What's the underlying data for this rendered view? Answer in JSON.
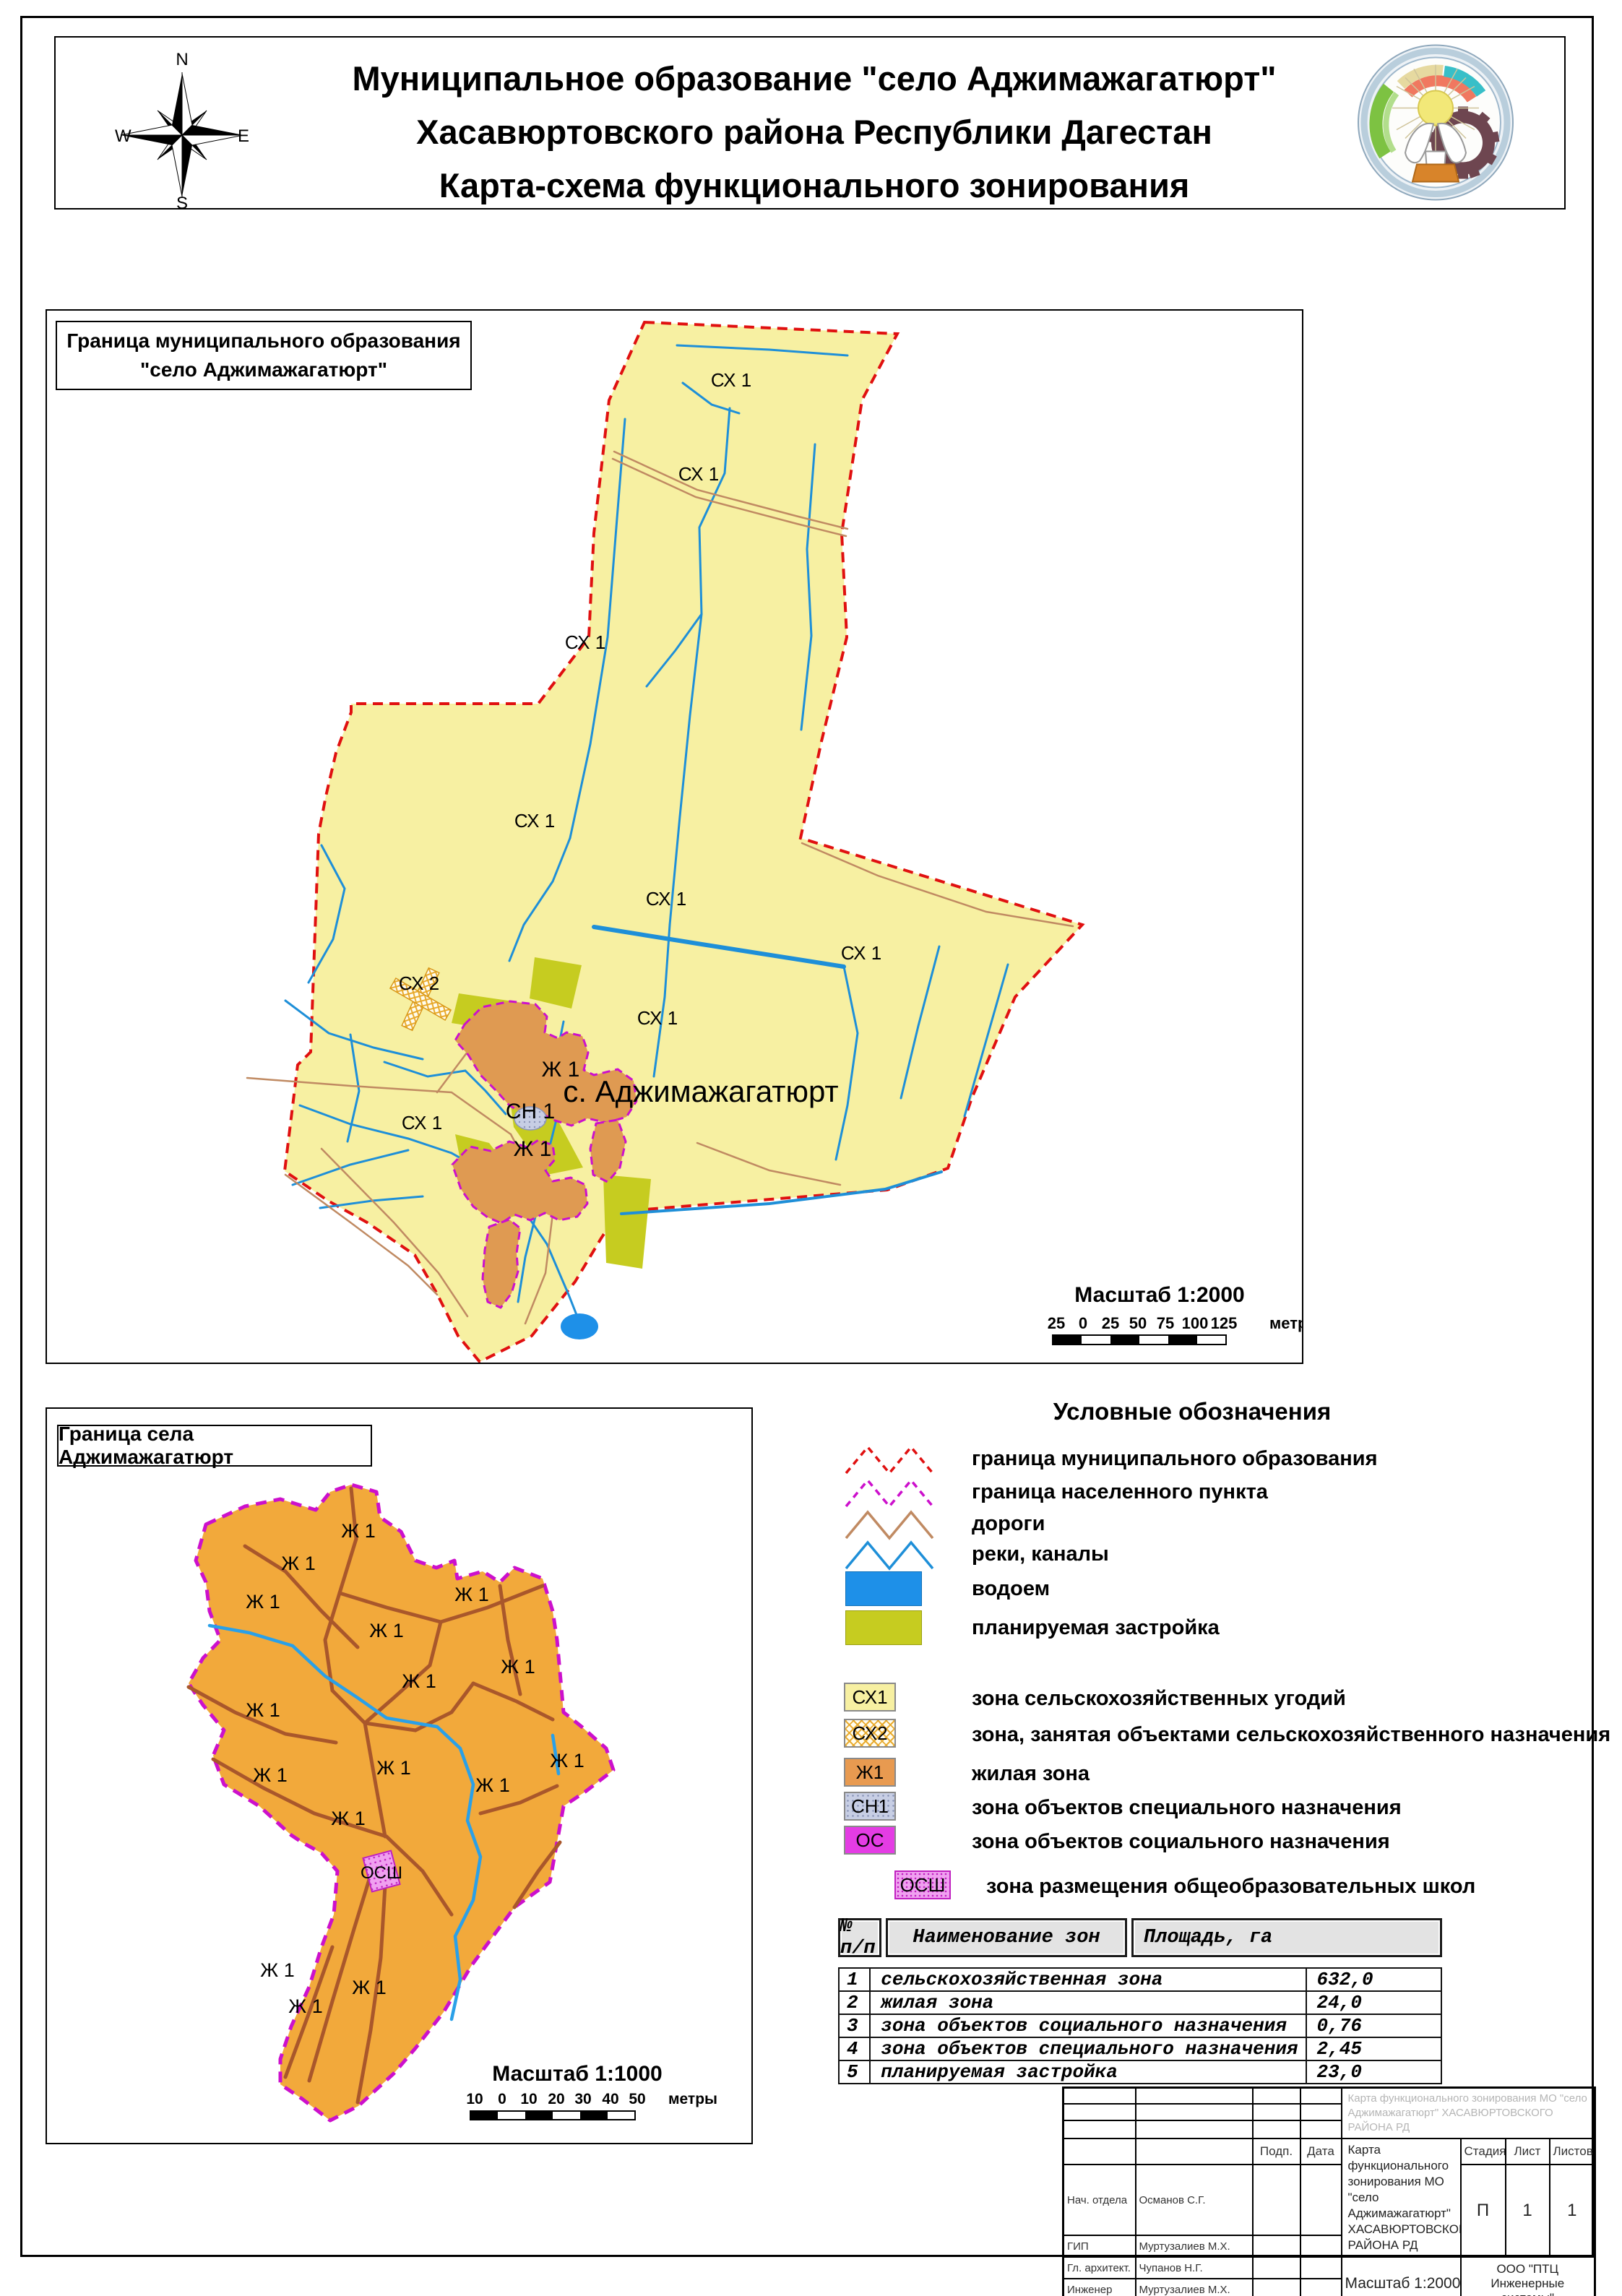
{
  "header": {
    "title_lines": [
      "Муниципальное образование \"село Аджимажагатюрт\"",
      "Хасавюртовского района Республики Дагестан",
      "Карта-схема функционального зонирования"
    ],
    "compass": {
      "n": "N",
      "e": "E",
      "s": "S",
      "w": "W"
    }
  },
  "map_main": {
    "frame_label_lines": [
      "Граница муниципального образования",
      "\"село Аджимажагатюрт\""
    ],
    "labels": [
      "СХ 1",
      "СХ 1",
      "СХ 1",
      "СХ 1",
      "СХ 1",
      "СХ 1",
      "СХ 1",
      "СХ 2",
      "СХ 1",
      "Ж 1",
      "СН 1",
      "Ж 1"
    ],
    "settlement_label": "с. Аджимажагатюрт",
    "scale": {
      "title": "Масштаб 1:2000",
      "ticks": [
        "25",
        "0",
        "25",
        "50",
        "75",
        "100",
        "125"
      ],
      "unit": "метры"
    }
  },
  "map_village": {
    "frame_label": "Граница села Аджимажагатюрт",
    "residential_label": "Ж 1",
    "school_label": "ОСШ",
    "scale": {
      "title": "Масштаб 1:1000",
      "ticks": [
        "10",
        "0",
        "10",
        "20",
        "30",
        "40",
        "50"
      ],
      "unit": "метры"
    }
  },
  "legend": {
    "title": "Условные обозначения",
    "line_items": [
      {
        "label": "граница муниципального образования"
      },
      {
        "label": "граница населенного пункта"
      },
      {
        "label": "дороги"
      },
      {
        "label": "реки, каналы"
      },
      {
        "label": "водоем"
      },
      {
        "label": "планируемая застройка"
      }
    ],
    "zone_items": [
      {
        "code": "СХ1",
        "label": "зона сельскохозяйственных угодий"
      },
      {
        "code": "СХ2",
        "label": "зона, занятая объектами сельскохозяйственного назначения"
      },
      {
        "code": "Ж1",
        "label": "жилая зона"
      },
      {
        "code": "СН1",
        "label": "зона объектов специального назначения"
      },
      {
        "code": "ОС",
        "label": "зона объектов социального назначения"
      },
      {
        "code": "ОСШ",
        "label": "зона размещения общеобразовательных школ"
      }
    ]
  },
  "zones_table": {
    "headers": [
      "№ п/п",
      "Наименование зон",
      "Площадь, га"
    ],
    "rows": [
      [
        "1",
        "сельскохозяйственная зона",
        "632,0"
      ],
      [
        "2",
        "жилая зона",
        "24,0"
      ],
      [
        "3",
        "зона объектов социального назначения",
        "0,76"
      ],
      [
        "4",
        "зона объектов специального назначения",
        "2,45"
      ],
      [
        "5",
        "планируемая застройка",
        "23,0"
      ]
    ]
  },
  "stamp": {
    "sign_col": "Подп.",
    "date_col": "Дата",
    "rows": [
      {
        "role": "Нач. отдела",
        "name": "Османов С.Г."
      },
      {
        "role": "ГИП",
        "name": "Муртузалиев М.Х."
      },
      {
        "role": "Гл. архитект.",
        "name": "Чупанов Н.Г."
      },
      {
        "role": "Инженер",
        "name": "Муртузалиев М.Х."
      }
    ],
    "project_title": "Карта функционального зонирования МО \"село Аджимажагатюрт\" ХАСАВЮРТОВСКОГО РАЙОНА РД",
    "stage_label": "Стадия",
    "sheet_label": "Лист",
    "sheets_label": "Листов",
    "stage": "П",
    "sheet": "1",
    "sheets": "1",
    "scale_note": "Масштаб 1:2000",
    "organization": "ООО \"ПТЦ Инженерные системы\""
  },
  "colors": {
    "agriculture_fill": "#F7F0A2",
    "residential_main_fill": "#DF9A52",
    "residential_village_fill": "#F2A93B",
    "planned_fill": "#C6CC20",
    "water_line": "#1E8FD8",
    "pond_fill": "#1E90E8",
    "road_main": "#C08A62",
    "road_village": "#A9572B",
    "municipal_boundary": "#E01010",
    "settlement_boundary": "#CC10CC",
    "special_zone_fill": "#C7CEE4",
    "social_zone_fill": "#E43CE4"
  }
}
